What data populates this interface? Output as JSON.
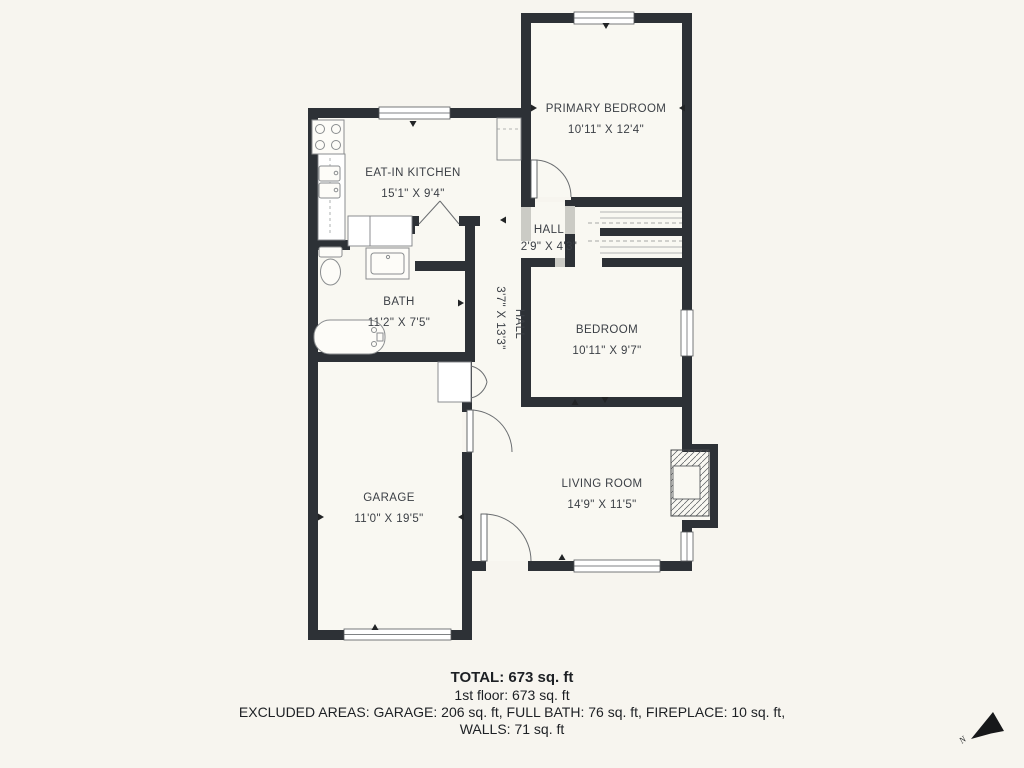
{
  "plan": {
    "rooms": [
      {
        "id": "kitchen",
        "name": "EAT-IN KITCHEN",
        "dims": "15'1\" X 9'4\""
      },
      {
        "id": "primary-bedroom",
        "name": "PRIMARY BEDROOM",
        "dims": "10'11\" X 12'4\""
      },
      {
        "id": "hall-small",
        "name": "HALL",
        "dims": "2'9\" X 4'3\""
      },
      {
        "id": "hall-long",
        "name": "HALL",
        "dims": "3'7\" X 13'3\""
      },
      {
        "id": "bath",
        "name": "BATH",
        "dims": "11'2\" X 7'5\""
      },
      {
        "id": "bedroom",
        "name": "BEDROOM",
        "dims": "10'11\" X 9'7\""
      },
      {
        "id": "living-room",
        "name": "LIVING ROOM",
        "dims": "14'9\" X 11'5\""
      },
      {
        "id": "garage",
        "name": "GARAGE",
        "dims": "11'0\" X 19'5\""
      }
    ],
    "compass": {
      "label": "N"
    }
  },
  "footer": {
    "total": "TOTAL: 673 sq. ft",
    "first_floor": "1st floor: 673 sq. ft",
    "excluded": "EXCLUDED AREAS: GARAGE: 206 sq. ft, FULL BATH: 76 sq. ft, FIREPLACE: 10 sq. ft,",
    "walls": "WALLS: 71 sq. ft"
  },
  "colors": {
    "background": "#f7f5ef",
    "wall": "#2d3136",
    "label_text": "#3b3f45",
    "footer_text": "#1d2024"
  }
}
